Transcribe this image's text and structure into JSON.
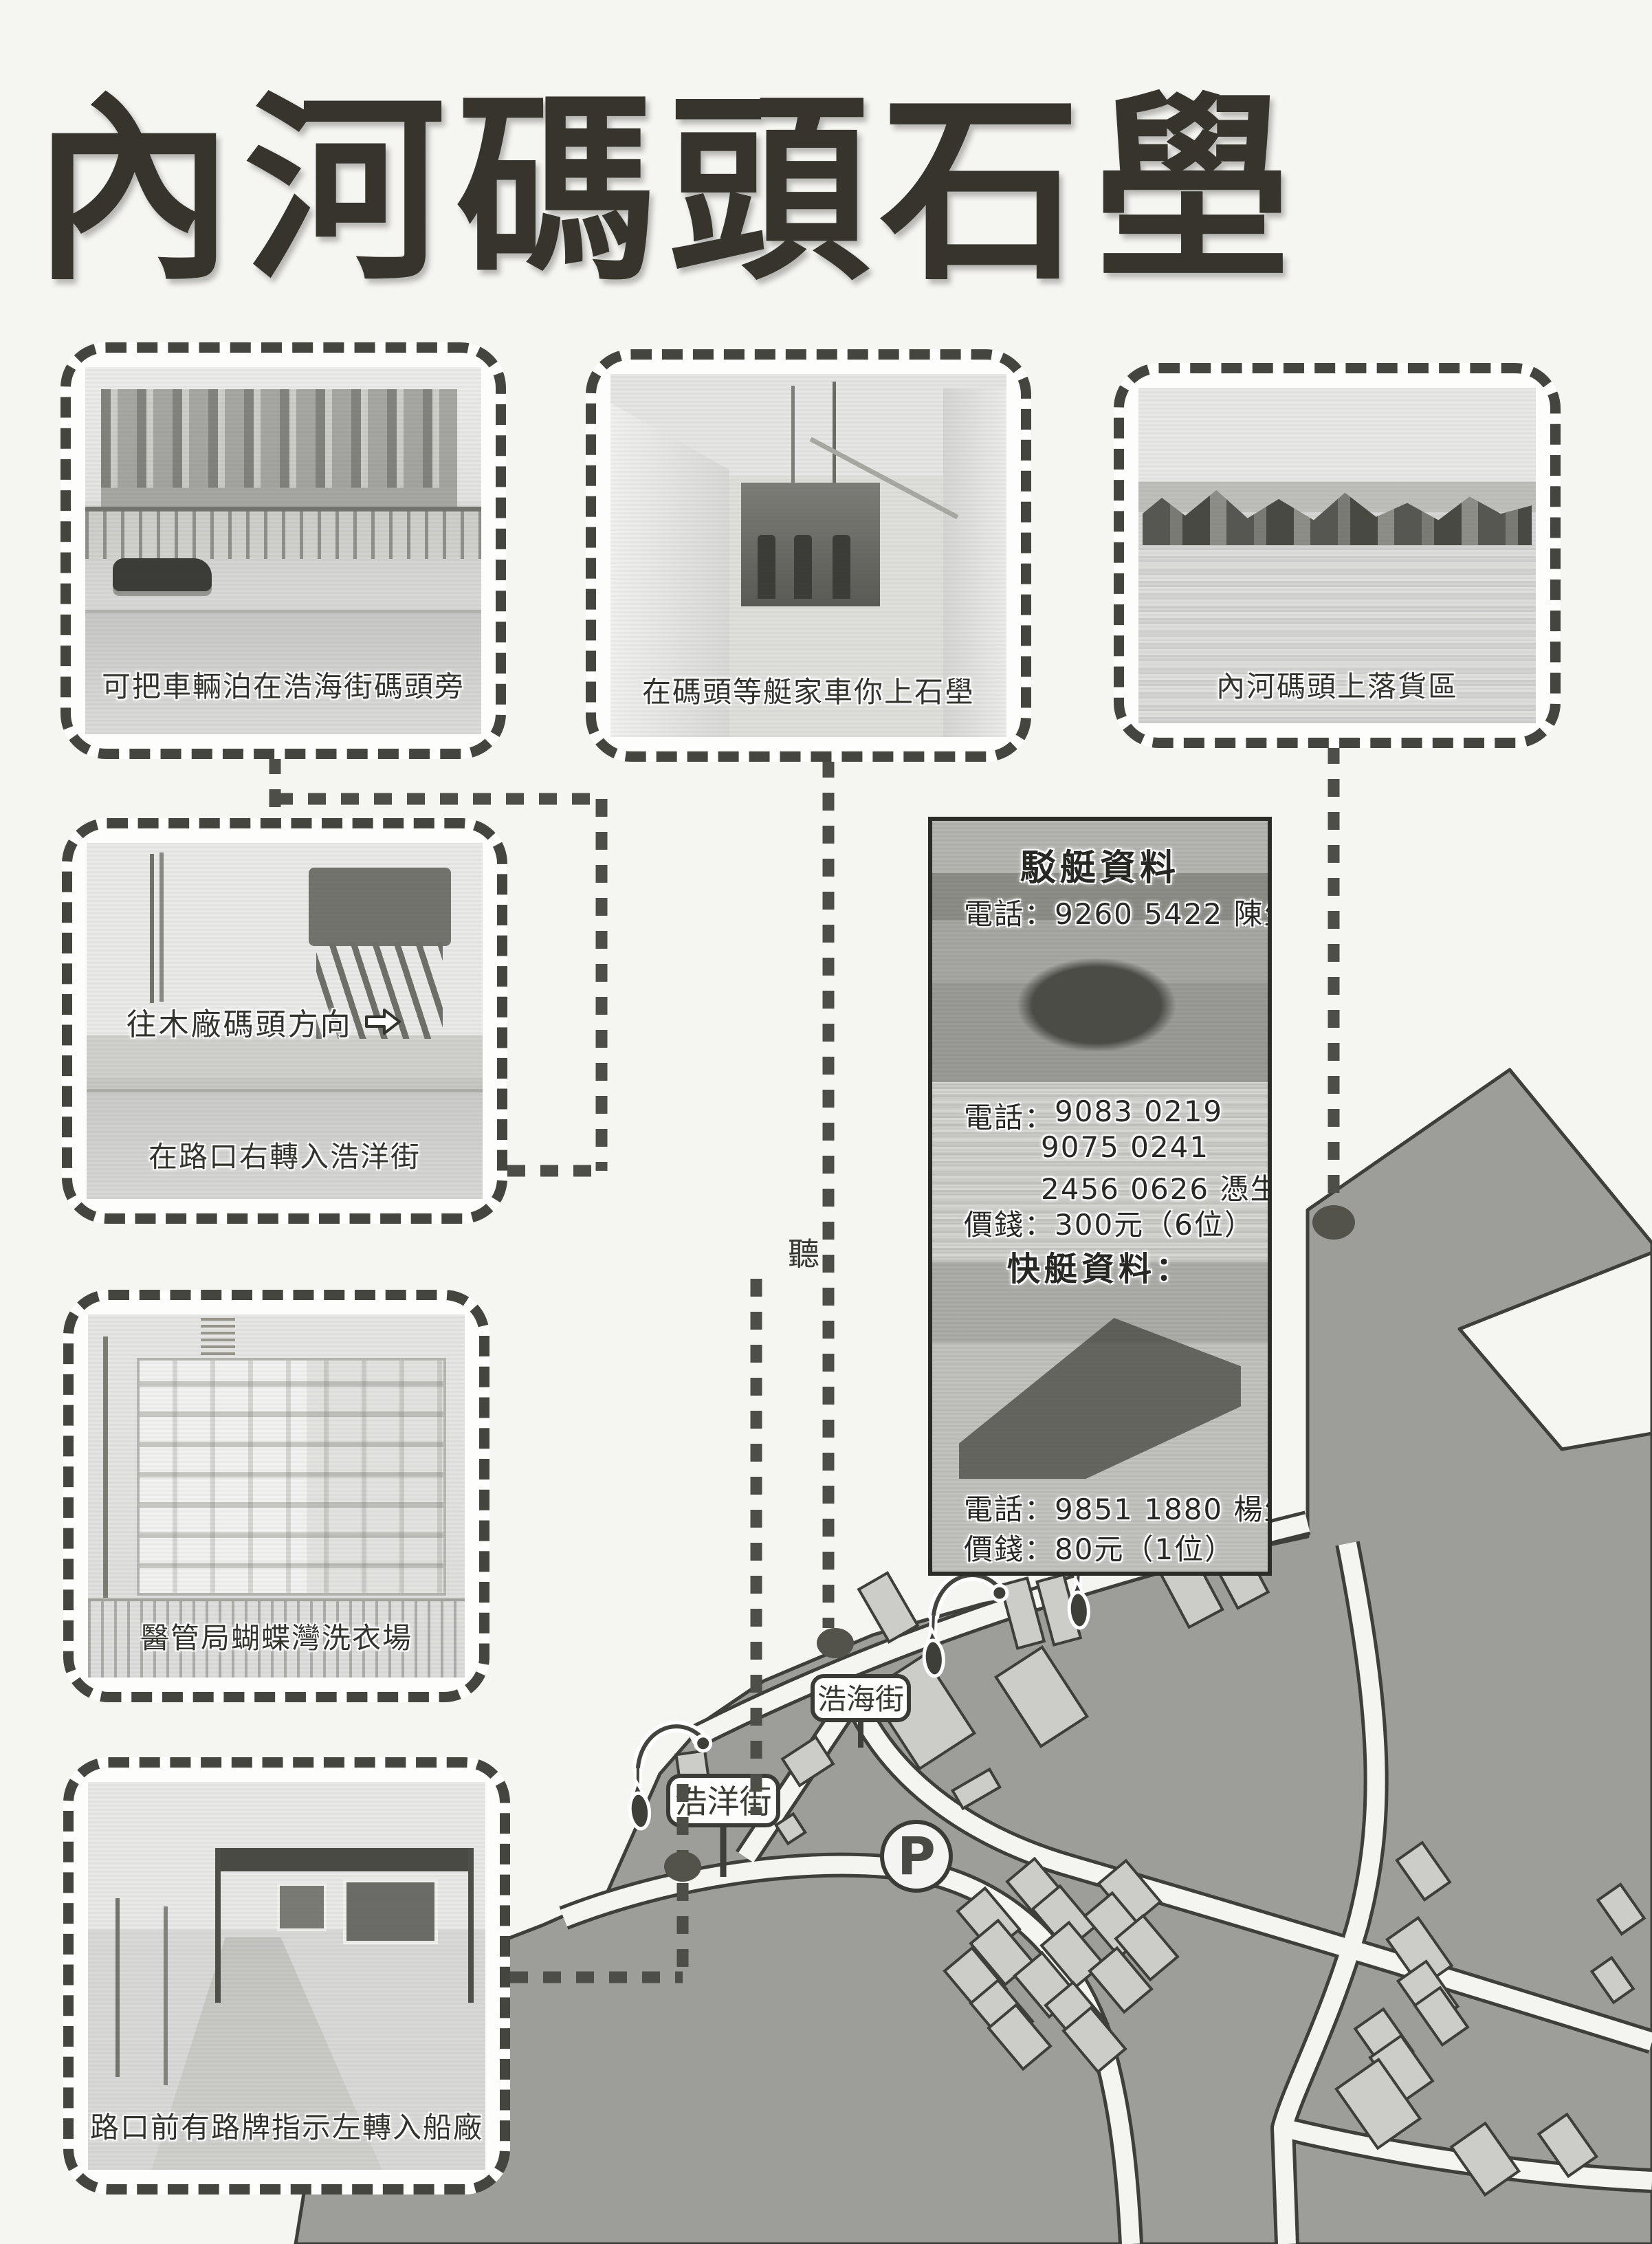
{
  "page": {
    "title": "內河碼頭石壆"
  },
  "photos": {
    "parking": {
      "caption": "可把車輛泊在浩海街碼頭旁"
    },
    "pier": {
      "caption": "在碼頭等艇家車你上石壆"
    },
    "cargo": {
      "caption": "內河碼頭上落貨區"
    },
    "junction": {
      "caption": "在路口右轉入浩洋街",
      "sign": "往木廠碼頭方向"
    },
    "laundry": {
      "caption": "醫管局蝴蝶灣洗衣場"
    },
    "shipyard": {
      "caption": "路口前有路牌指示左轉入船廠"
    }
  },
  "info_panel": {
    "barge_title": "駁艇資料",
    "phone_label": "電話：",
    "price_label": "價錢：",
    "barge_phone1": "9260 5422 陳生",
    "barge_phone2": "9083 0219",
    "barge_phone3": "9075 0241",
    "barge_phone4": "2456 0626 憑生",
    "barge_price": "300元（6位）",
    "speedboat_title": "快艇資料：",
    "speedboat_phone": "9851 1880 楊生",
    "speedboat_price": "80元（1位）"
  },
  "map": {
    "street_hoi_hoi": "浩海街",
    "street_hoi_yeung": "浩洋街",
    "parking_symbol": "P"
  },
  "stray_char": "聽",
  "colors": {
    "land": "#9d9d9a",
    "building": "#ccccc9",
    "outline": "#3e3e3a",
    "dash": "#4e4e48",
    "accent_text": "#2f2f2b"
  }
}
